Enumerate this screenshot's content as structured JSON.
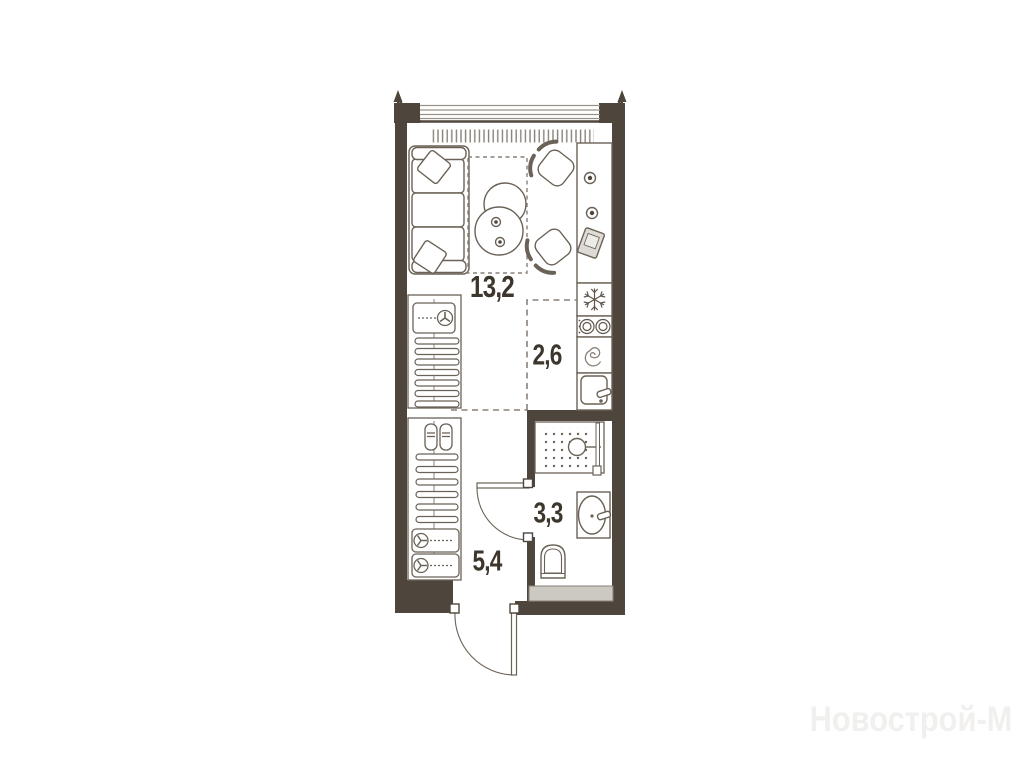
{
  "floorplan": {
    "title": "Studio apartment floor plan",
    "rooms": [
      {
        "id": "living-kitchen",
        "area": "13,2"
      },
      {
        "id": "kitchen-zone",
        "area": "2,6"
      },
      {
        "id": "bathroom",
        "area": "3,3"
      },
      {
        "id": "hallway",
        "area": "5,4"
      }
    ],
    "watermark": "Новострой-М",
    "colors": {
      "wall": "#4e463c",
      "furniture_line": "#6b6257",
      "dashed_zone": "#8a8178",
      "shaft_fill": "#ccc8c2",
      "label_text": "#3d362d",
      "watermark_text": "#f1f0ee"
    },
    "icons": [
      "window-icon",
      "radiator-icon",
      "corner-arrow-icon",
      "sofa-icon",
      "pillow-icon",
      "coffee-tables-icon",
      "chair-icon",
      "cup-icon",
      "laptop-icon",
      "fridge-snowflake-icon",
      "hob-burners-icon",
      "washing-machine-spiral-icon",
      "kitchen-sink-icon",
      "hanger-icon",
      "vacuum-box-icon",
      "shoes-icon",
      "storage-box-icon",
      "shower-icon",
      "shower-glass-icon",
      "bath-sink-icon",
      "toilet-icon",
      "door-swing-icon",
      "entry-door-swing-icon"
    ]
  }
}
